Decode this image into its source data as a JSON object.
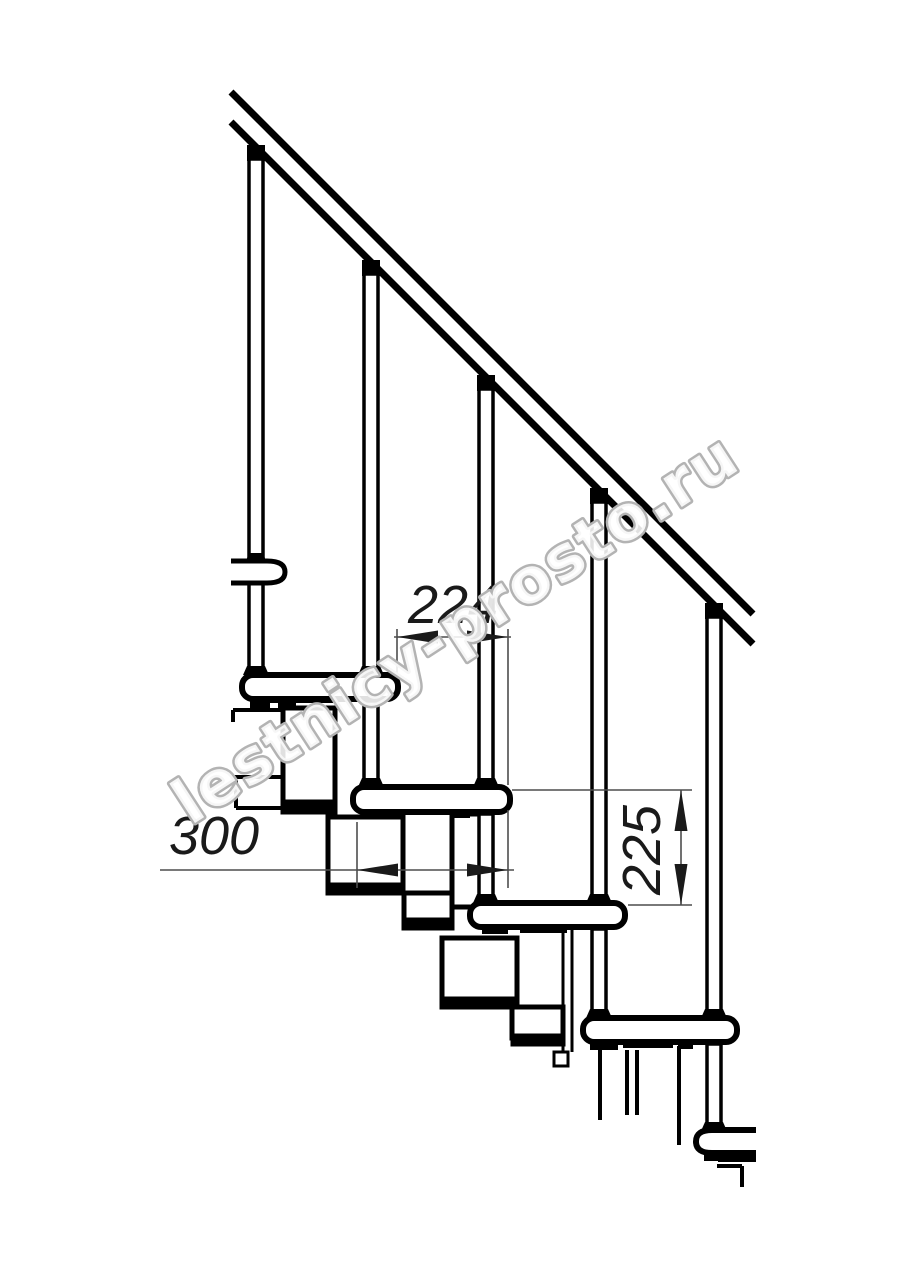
{
  "page": {
    "background_color": "#ffffff",
    "content": "technical line drawing, side elevation of a modular staircase with handrail, balusters, treads and zigzag support modules"
  },
  "drawing": {
    "line_color": "#000000",
    "dimension_color": "#4d4d4d",
    "element_counts": {
      "handrail_lines": 2,
      "balusters": 5,
      "treads_side_view": 5,
      "tread_edge_on": 1
    },
    "dimensions": [
      {
        "label": "224",
        "value": 224,
        "orientation": "horizontal"
      },
      {
        "label": "300",
        "value": 300,
        "orientation": "horizontal"
      },
      {
        "label": "225",
        "value": 225,
        "orientation": "vertical"
      }
    ],
    "watermark": {
      "text": "lestnicy-prosto.ru",
      "outline_color": "#b3b3b3"
    }
  }
}
